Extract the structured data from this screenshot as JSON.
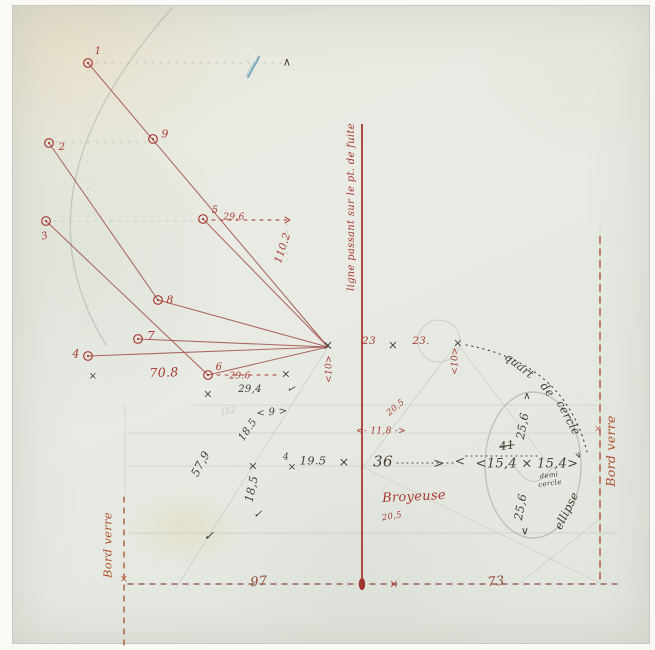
{
  "colors": {
    "red": "#a63a32",
    "brown": "#8f4a38",
    "orange": "#ad512c",
    "dark": "#453c33",
    "pencil": "#8f988f",
    "blue": "#5f9db5"
  },
  "labels": [
    {
      "n": "point-1-label",
      "t": "1",
      "x": 98,
      "y": 52,
      "r": 0,
      "c": "red",
      "s": 10
    },
    {
      "n": "point-9-label",
      "t": "9",
      "x": 165,
      "y": 134,
      "r": 0,
      "c": "red",
      "s": 11
    },
    {
      "n": "point-2-label",
      "t": "2",
      "x": 62,
      "y": 148,
      "r": 0,
      "c": "red",
      "s": 10
    },
    {
      "n": "point-5-label",
      "t": "5",
      "x": 215,
      "y": 211,
      "r": 0,
      "c": "red",
      "s": 10
    },
    {
      "n": "point-3-label",
      "t": "3",
      "x": 45,
      "y": 237,
      "r": -15,
      "c": "red",
      "s": 10
    },
    {
      "n": "point-8-label",
      "t": "8",
      "x": 170,
      "y": 300,
      "r": 0,
      "c": "red",
      "s": 11
    },
    {
      "n": "point-7-label",
      "t": "7",
      "x": 151,
      "y": 336,
      "r": 0,
      "c": "red",
      "s": 12
    },
    {
      "n": "point-4-label",
      "t": "4",
      "x": 76,
      "y": 354,
      "r": 0,
      "c": "red",
      "s": 11
    },
    {
      "n": "point-6-label",
      "t": "6",
      "x": 219,
      "y": 368,
      "r": 0,
      "c": "red",
      "s": 10
    },
    {
      "n": "measure-29-6-upper",
      "t": "29.6",
      "x": 234,
      "y": 218,
      "r": 0,
      "c": "red",
      "s": 9
    },
    {
      "n": "measure-110-2",
      "t": "110.2",
      "x": 283,
      "y": 248,
      "r": -72,
      "c": "red",
      "s": 10.5
    },
    {
      "n": "measure-70-8",
      "t": "70.8",
      "x": 164,
      "y": 373,
      "r": -2,
      "c": "red",
      "s": 12.5
    },
    {
      "n": "measure-29-6-lower",
      "t": "29.6",
      "x": 240,
      "y": 377,
      "r": 0,
      "c": "red",
      "s": 9
    },
    {
      "n": "measure-29-4",
      "t": "29,4",
      "x": 250,
      "y": 390,
      "r": 0,
      "c": "dark",
      "s": 10
    },
    {
      "n": "axis-annotation",
      "t": "ligne passant sur le pt. de fuite",
      "x": 352,
      "y": 207,
      "r": -90,
      "c": "red",
      "s": 10
    },
    {
      "n": "measure-23-left",
      "t": "23",
      "x": 369,
      "y": 341,
      "r": 0,
      "c": "red",
      "s": 10.5
    },
    {
      "n": "measure-23-right",
      "t": "23.",
      "x": 421,
      "y": 341,
      "r": 0,
      "c": "red",
      "s": 10.5
    },
    {
      "n": "measure-10-left",
      "t": "<10>",
      "x": 330,
      "y": 369,
      "r": -90,
      "c": "red",
      "s": 9
    },
    {
      "n": "measure-10-right",
      "t": "<10>",
      "x": 456,
      "y": 361,
      "r": -90,
      "c": "red",
      "s": 9
    },
    {
      "n": "measure-11-8",
      "t": "<- 11,8 ->",
      "x": 381,
      "y": 432,
      "r": 0,
      "c": "red",
      "s": 9
    },
    {
      "n": "measure-20-5-upper",
      "t": "20,5",
      "x": 396,
      "y": 408,
      "r": -40,
      "c": "red",
      "s": 8.5
    },
    {
      "n": "measure-20-5-lower",
      "t": "20,5",
      "x": 392,
      "y": 517,
      "r": -10,
      "c": "red",
      "s": 8.5
    },
    {
      "n": "broyeuse-label",
      "t": "Broyeuse",
      "x": 414,
      "y": 497,
      "r": -3,
      "c": "red",
      "s": 13
    },
    {
      "n": "measure-97",
      "t": "97",
      "x": 259,
      "y": 582,
      "r": -5,
      "c": "brown",
      "s": 13
    },
    {
      "n": "measure-73",
      "t": "73",
      "x": 496,
      "y": 582,
      "r": -5,
      "c": "brown",
      "s": 13
    },
    {
      "n": "bord-verre-left",
      "t": "Bord verre",
      "x": 108,
      "y": 545,
      "r": -90,
      "c": "orange",
      "s": 11.5
    },
    {
      "n": "bord-verre-right",
      "t": "Bord verre",
      "x": 611,
      "y": 451,
      "r": -90,
      "c": "orange",
      "s": 12.5
    },
    {
      "n": "measure-36",
      "t": "36",
      "x": 383,
      "y": 462,
      "r": 0,
      "c": "dark",
      "s": 15
    },
    {
      "n": "measure-19-5",
      "t": "19.5",
      "x": 313,
      "y": 461,
      "r": 0,
      "c": "dark",
      "s": 11.5
    },
    {
      "n": "measure-4-small",
      "t": "4",
      "x": 286,
      "y": 458,
      "r": 0,
      "c": "dark",
      "s": 9
    },
    {
      "n": "measure-18-5-upper",
      "t": "18.5",
      "x": 248,
      "y": 430,
      "r": -55,
      "c": "dark",
      "s": 10.5
    },
    {
      "n": "measure-9-bracket",
      "t": "< 9 >",
      "x": 272,
      "y": 413,
      "r": -5,
      "c": "dark",
      "s": 10
    },
    {
      "n": "measure-57-9",
      "t": "57,9",
      "x": 201,
      "y": 464,
      "r": -62,
      "c": "dark",
      "s": 11.5
    },
    {
      "n": "measure-18-5-lower",
      "t": "18,5",
      "x": 252,
      "y": 489,
      "r": -78,
      "c": "dark",
      "s": 11.5
    },
    {
      "n": "pencil-note-52",
      "t": "(52",
      "x": 229,
      "y": 412,
      "r": -10,
      "c": "pencil",
      "s": 8.5,
      "o": 0.45
    },
    {
      "n": "measure-15-4-pair",
      "t": "<15,4 × 15,4>",
      "x": 527,
      "y": 464,
      "r": 0,
      "c": "dark",
      "s": 13
    },
    {
      "n": "measure-41-struck",
      "t": "41",
      "x": 507,
      "y": 446,
      "r": -8,
      "c": "dark",
      "s": 11.5,
      "k": "strike"
    },
    {
      "n": "measure-25-6-upper",
      "t": "25,6",
      "x": 523,
      "y": 426,
      "r": -80,
      "c": "dark",
      "s": 11.5
    },
    {
      "n": "measure-25-6-lower",
      "t": "25,6",
      "x": 521,
      "y": 507,
      "r": -80,
      "c": "dark",
      "s": 11.5
    },
    {
      "n": "demi-cercle-word-1",
      "t": "demi",
      "x": 549,
      "y": 476,
      "r": -8,
      "c": "dark",
      "s": 7
    },
    {
      "n": "demi-cercle-word-2",
      "t": "cercle",
      "x": 550,
      "y": 484,
      "r": -8,
      "c": "dark",
      "s": 7
    },
    {
      "n": "ellipse-label",
      "t": "ellipse",
      "x": 567,
      "y": 511,
      "r": -64,
      "c": "dark",
      "s": 11.5
    },
    {
      "n": "quart-de-cercle-word-1",
      "t": "quart",
      "x": 519,
      "y": 366,
      "r": 38,
      "c": "dark",
      "s": 11.5
    },
    {
      "n": "quart-de-cercle-word-2",
      "t": "de",
      "x": 547,
      "y": 390,
      "r": 52,
      "c": "dark",
      "s": 11.5
    },
    {
      "n": "quart-de-cercle-word-3",
      "t": "cercle",
      "x": 568,
      "y": 418,
      "r": 62,
      "c": "dark",
      "s": 11.5
    },
    {
      "n": "vanishing-point-x",
      "t": "×",
      "x": 328,
      "y": 346,
      "r": 0,
      "c": "dark",
      "s": 13
    },
    {
      "n": "x-mark-23-row",
      "t": "×",
      "x": 393,
      "y": 345,
      "r": 0,
      "c": "dark",
      "s": 12
    },
    {
      "n": "x-mark-quart-start",
      "t": "×",
      "x": 458,
      "y": 343,
      "r": 0,
      "c": "dark",
      "s": 11
    },
    {
      "n": "x-mark-29-4-end",
      "t": "×",
      "x": 286,
      "y": 374,
      "r": 0,
      "c": "dark",
      "s": 11
    },
    {
      "n": "check-mark-29-4",
      "t": "✓",
      "x": 291,
      "y": 390,
      "r": 15,
      "c": "dark",
      "s": 10
    },
    {
      "n": "x-mark-below-6",
      "t": "×",
      "x": 208,
      "y": 394,
      "r": 0,
      "c": "dark",
      "s": 11
    },
    {
      "n": "x-mark-row-left",
      "t": "×",
      "x": 253,
      "y": 466,
      "r": 0,
      "c": "dark",
      "s": 11.5
    },
    {
      "n": "x-mark-row-right",
      "t": "×",
      "x": 344,
      "y": 462,
      "r": 0,
      "c": "dark",
      "s": 12.5
    },
    {
      "n": "x-mark-under-4",
      "t": "×",
      "x": 292,
      "y": 467,
      "r": 0,
      "c": "dark",
      "s": 10.5
    },
    {
      "n": "check-mark-center",
      "t": "✓",
      "x": 258,
      "y": 514,
      "r": 0,
      "c": "dark",
      "s": 11
    },
    {
      "n": "check-mark-lower-left",
      "t": "✓",
      "x": 209,
      "y": 536,
      "r": 0,
      "c": "dark",
      "s": 12.5
    },
    {
      "n": "caret-top-right",
      "t": "∧",
      "x": 287,
      "y": 62,
      "r": 0,
      "c": "dark",
      "s": 11
    },
    {
      "n": "x-mark-left-edge",
      "t": "×",
      "x": 93,
      "y": 377,
      "r": 0,
      "c": "dark",
      "s": 10
    },
    {
      "n": "x-mark-bord-left",
      "t": "×",
      "x": 124,
      "y": 580,
      "r": 0,
      "c": "orange",
      "s": 10
    },
    {
      "n": "x-mark-baseline",
      "t": "×",
      "x": 394,
      "y": 584,
      "r": 0,
      "c": "red",
      "s": 11
    },
    {
      "n": "x-mark-bord-right",
      "t": "×",
      "x": 598,
      "y": 430,
      "r": 0,
      "c": "red",
      "s": 9,
      "o": 0.7
    },
    {
      "n": "arrow-36-to-ellipse",
      "t": ">",
      "x": 439,
      "y": 464,
      "r": 0,
      "c": "dark",
      "s": 13
    },
    {
      "n": "arrow-41-left",
      "t": "<",
      "x": 460,
      "y": 461,
      "r": 0,
      "c": "dark",
      "s": 12
    },
    {
      "n": "arrow-ellipse-top",
      "t": "∧",
      "x": 527,
      "y": 397,
      "r": 0,
      "c": "dark",
      "s": 10
    },
    {
      "n": "arrow-ellipse-bottom",
      "t": "∨",
      "x": 525,
      "y": 531,
      "r": 0,
      "c": "dark",
      "s": 11
    },
    {
      "n": "arrow-quart-end",
      "t": "∨",
      "x": 579,
      "y": 456,
      "r": -25,
      "c": "dark",
      "s": 9
    }
  ]
}
